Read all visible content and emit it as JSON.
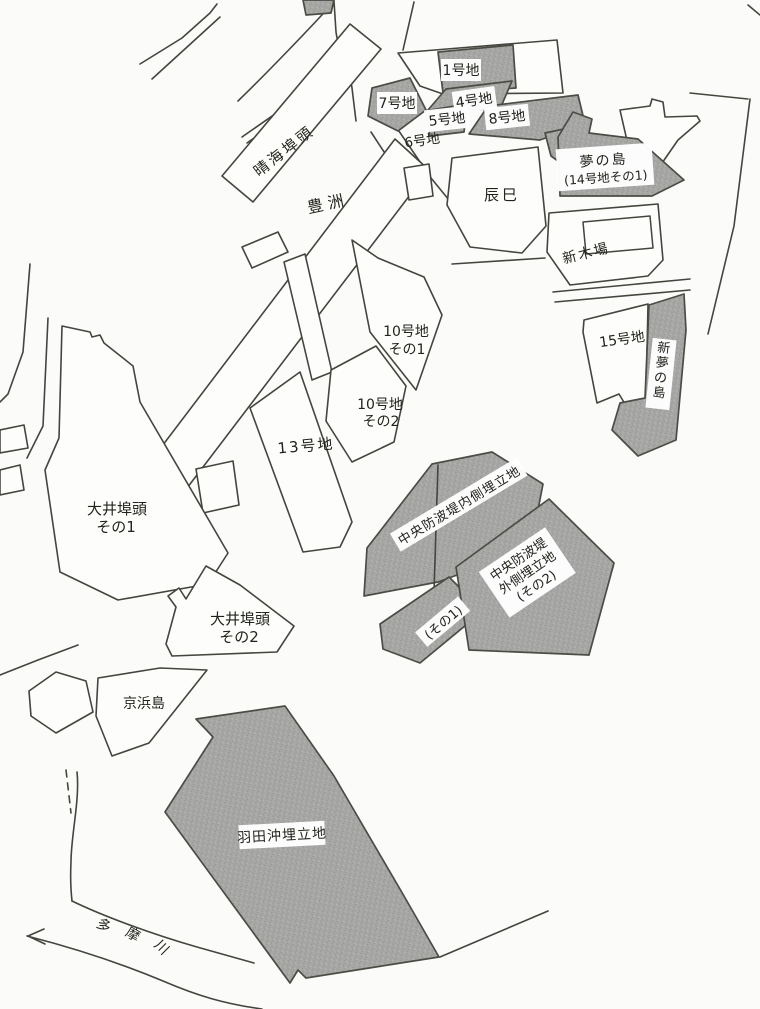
{
  "colors": {
    "background": "#fbfbf9",
    "outline": "#45453f",
    "shaded_fill": "#a5a5a3",
    "label_box": "#ffffff",
    "label_text": "#23231d"
  },
  "labels": {
    "lot1": "1号地",
    "lot4": "4号地",
    "lot5": "5号地",
    "lot6": "6号地",
    "lot7": "7号地",
    "lot8": "8号地",
    "harumi_wharf": "晴海埠頭",
    "toyosu": "豊洲",
    "tatsumi": "辰巳",
    "yumenoshima": "夢の島",
    "yumenoshima_sub": "(14号地その1)",
    "shinkiba": "新木場",
    "lot10_1a": "10号地",
    "lot10_1b": "その1",
    "lot10_2a": "10号地",
    "lot10_2b": "その2",
    "lot13": "13号地",
    "lot15": "15号地",
    "shin_yumenoshima": "新夢の島",
    "oi1a": "大井埠頭",
    "oi1b": "その1",
    "oi2a": "大井埠頭",
    "oi2b": "その2",
    "keihinjima": "京浜島",
    "chubo_inner": "中央防波堤内側埋立地",
    "chubo_sono1": "(その1)",
    "chubo_outer1": "中央防波堤",
    "chubo_outer2": "外側埋立地",
    "chubo_outer3": "(その2)",
    "haneda_oki": "羽田沖埋立地",
    "tama1": "多",
    "tama2": "摩",
    "tama3": "川"
  }
}
